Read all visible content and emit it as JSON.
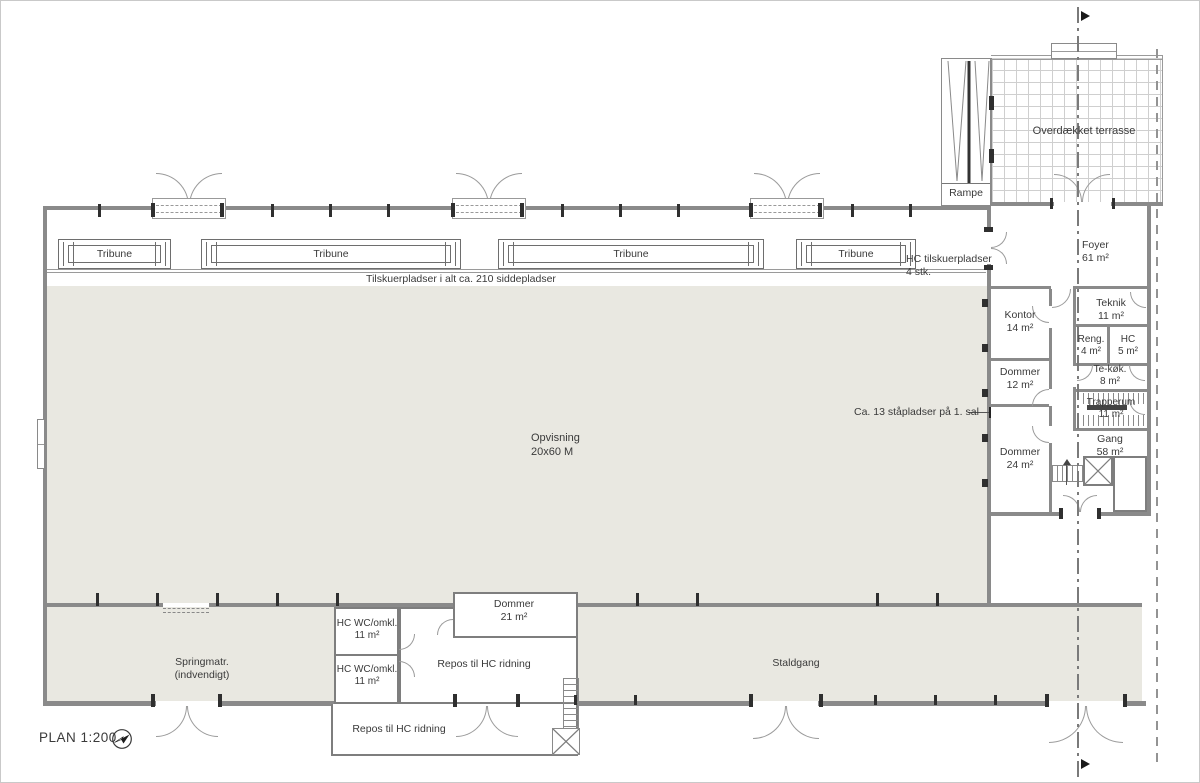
{
  "plan": {
    "title": "PLAN 1:200"
  },
  "arena": {
    "name": "Opvisning",
    "dimensions": "20x60 M"
  },
  "seating": {
    "tribunes": [
      "Tribune",
      "Tribune",
      "Tribune",
      "Tribune"
    ],
    "total_note": "Tilskuerpladser i alt ca. 210 siddepladser",
    "hc_note_line1": "HC tilskuerpladser",
    "hc_note_line2": "4 stk.",
    "standing_note": "Ca. 13 ståpladser på 1. sal"
  },
  "outdoor": {
    "terrace": "Overdækket terrasse",
    "ramp": "Rampe"
  },
  "rooms": {
    "foyer": {
      "name": "Foyer",
      "area": "61 m²"
    },
    "kontor": {
      "name": "Kontor",
      "area": "14 m²"
    },
    "teknik": {
      "name": "Teknik",
      "area": "11 m²"
    },
    "rengoring": {
      "name": "Reng.",
      "area": "4 m²"
    },
    "hc_toilet": {
      "name": "HC",
      "area": "5 m²"
    },
    "dommer12": {
      "name": "Dommer",
      "area": "12 m²"
    },
    "tekokken": {
      "name": "Te-køk.",
      "area": "8 m²"
    },
    "trapperum": {
      "name": "Trapperum",
      "area": "11 m²"
    },
    "gang": {
      "name": "Gang",
      "area": "58 m²"
    },
    "dommer24": {
      "name": "Dommer",
      "area": "24 m²"
    },
    "springmatr": {
      "name": "Springmatr.",
      "sub": "(indvendigt)"
    },
    "hcwc_upper": {
      "name": "HC WC/omkl.",
      "area": "11 m²"
    },
    "hcwc_lower": {
      "name": "HC WC/omkl.",
      "area": "11 m²"
    },
    "dommer21": {
      "name": "Dommer",
      "area": "21 m²"
    },
    "repos_inner": {
      "name": "Repos til HC ridning"
    },
    "repos_outer": {
      "name": "Repos til HC ridning"
    },
    "staldgang": {
      "name": "Staldgang"
    }
  },
  "colors": {
    "floor": "#e9e8e1",
    "wall": "#8a8a8a",
    "text": "#3a3a3a"
  }
}
